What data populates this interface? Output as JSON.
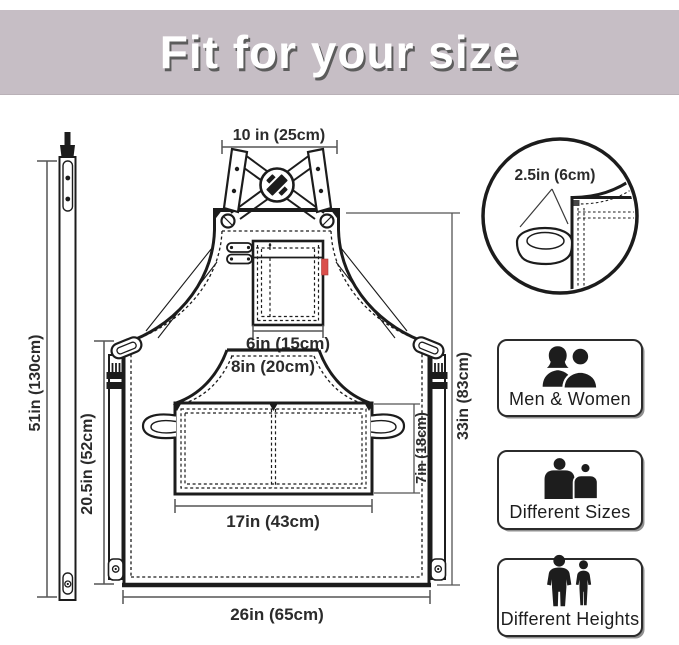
{
  "banner": {
    "title": "Fit for your size",
    "bg_color": "#c6bec5",
    "text_color": "#ffffff",
    "shadow_color": "#5c5c5c"
  },
  "diagram": {
    "dims": {
      "top_width": "10 in (25cm)",
      "chest_pocket": "6in (15cm)",
      "pocket_top": "8in (20cm)",
      "pocket_width": "17in (43cm)",
      "pocket_height": "7in (18cm)",
      "hem_width": "26in (65cm)",
      "strap_length": "51in (130cm)",
      "side_length": "20.5in (52cm)",
      "apron_length": "33in (83cm)"
    },
    "detail": {
      "loop_width": "2.5in (6cm)"
    },
    "colors": {
      "line": "#1c1c1c",
      "dim_line": "#555555",
      "tag_red": "#da4f4b"
    }
  },
  "features": [
    {
      "label": "Men & Women",
      "icon": "men-women-icon"
    },
    {
      "label": "Different Sizes",
      "icon": "different-sizes-icon"
    },
    {
      "label": "Different Heights",
      "icon": "different-heights-icon"
    }
  ]
}
